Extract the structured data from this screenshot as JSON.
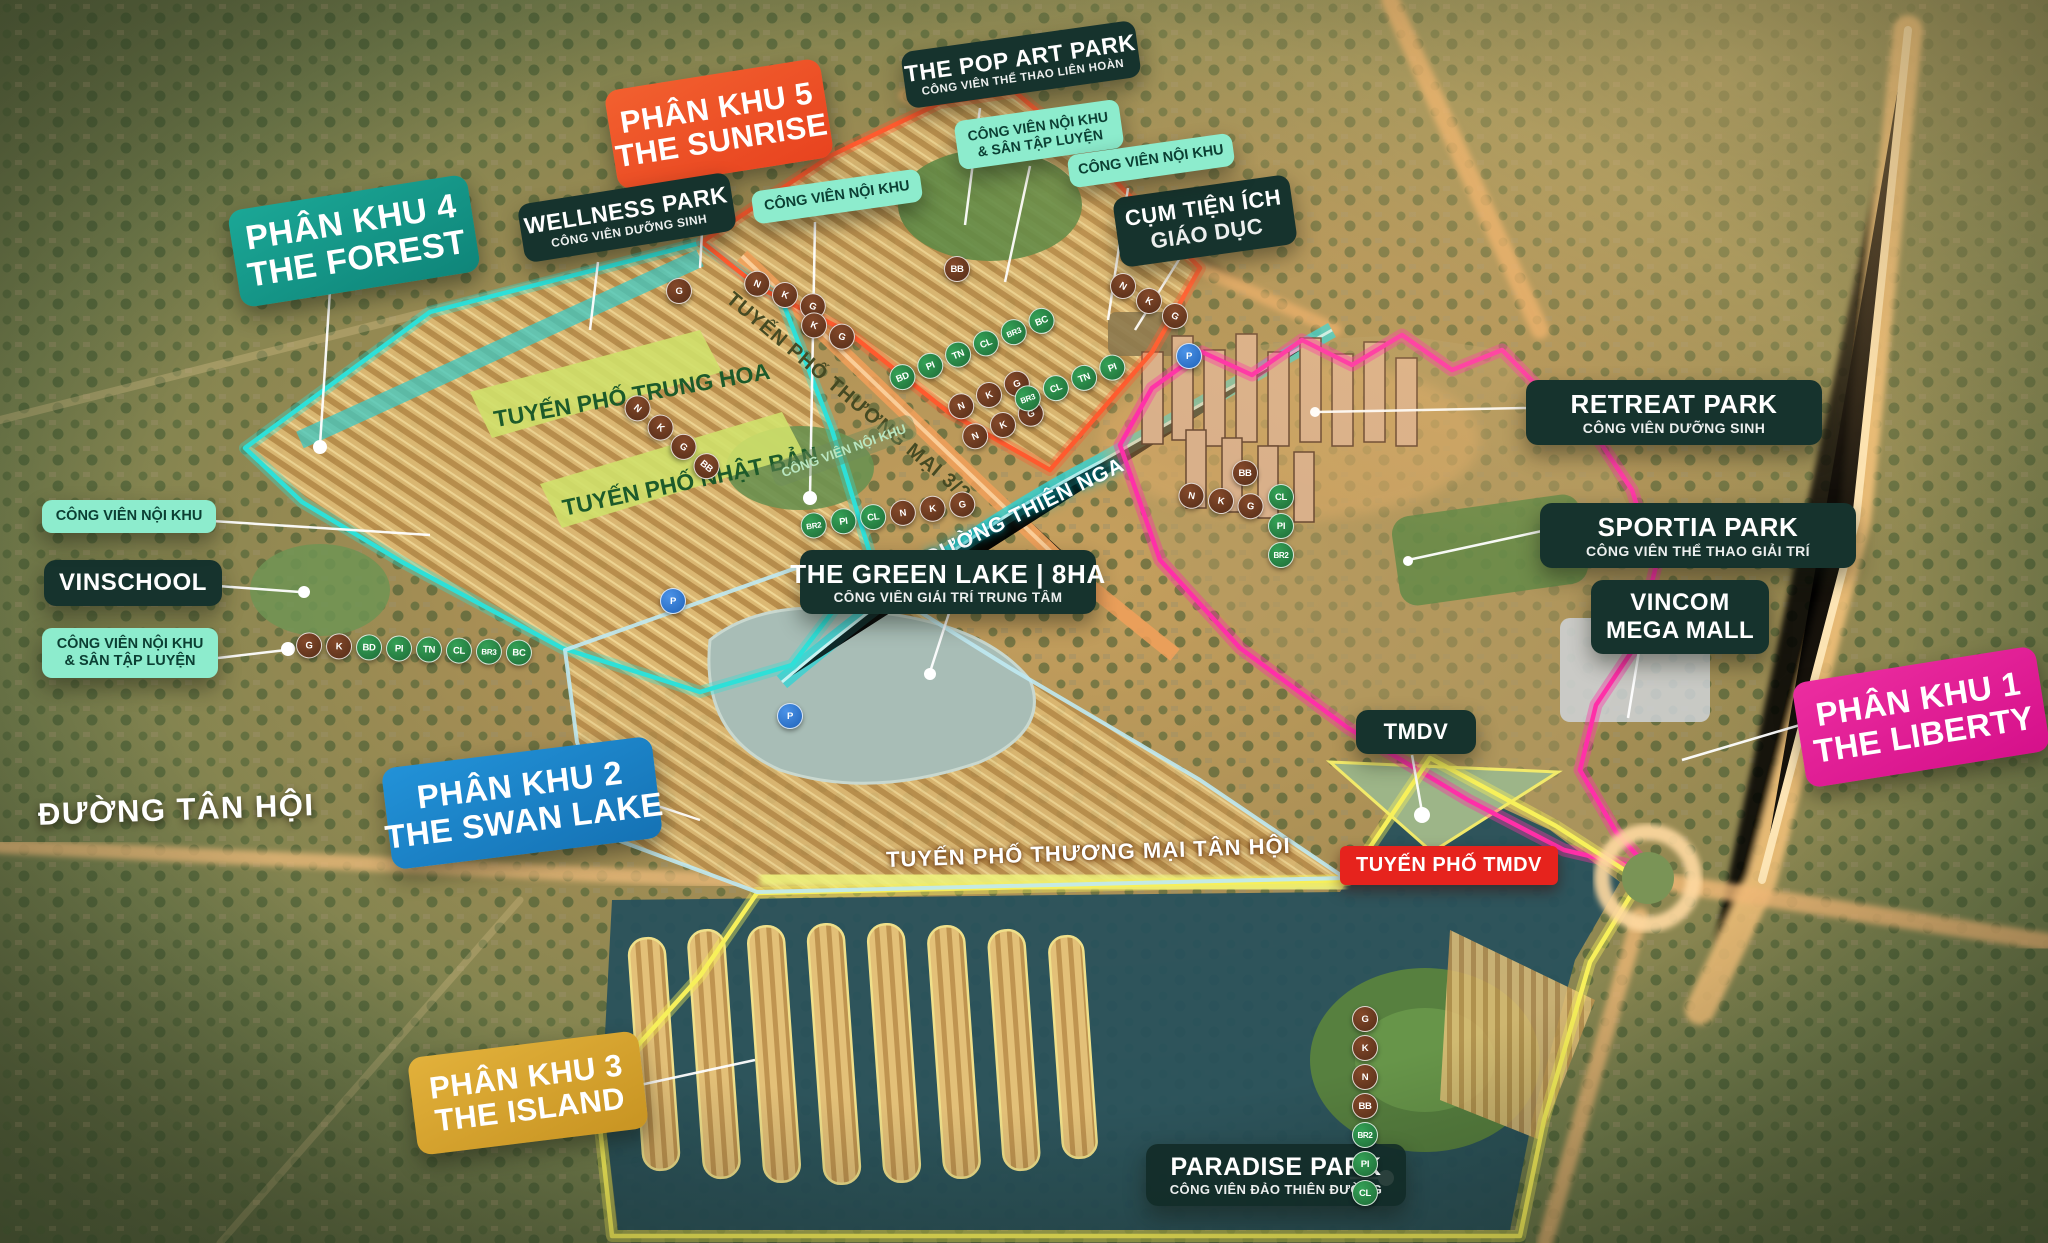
{
  "project": {
    "type": "real-estate masterplan aerial map",
    "colors": {
      "zone1_liberty": "#e0218f",
      "zone2_swan_lake": "#1e85c9",
      "zone3_island": "#d9a62e",
      "zone4_forest": "#14998c",
      "zone5_sunrise": "#f0512f",
      "outline_cyan": "#2ee0d8",
      "outline_orange": "#ff5a2e",
      "outline_magenta": "#ff2fa8",
      "outline_yellow": "#f7f05a",
      "outline_pale_blue": "#bfe9f2",
      "dark_badge": "#16332d",
      "mint_badge": "#8deccd",
      "red_badge": "#e6231d",
      "marker_brown": "#6d3a22",
      "marker_green": "#2e8f4b",
      "marker_blue": "#2e7fd9"
    }
  },
  "zones": {
    "pk1": {
      "line1": "PHÂN KHU 1",
      "line2": "THE LIBERTY"
    },
    "pk2": {
      "line1": "PHÂN KHU 2",
      "line2": "THE SWAN LAKE"
    },
    "pk3": {
      "line1": "PHÂN KHU 3",
      "line2": "THE ISLAND"
    },
    "pk4": {
      "line1": "PHÂN KHU 4",
      "line2": "THE FOREST"
    },
    "pk5": {
      "line1": "PHÂN KHU 5",
      "line2": "THE SUNRISE"
    }
  },
  "parks": {
    "wellness": {
      "title": "WELLNESS PARK",
      "subtitle": "CÔNG VIÊN DƯỠNG SINH"
    },
    "pop_art": {
      "title": "THE POP ART PARK",
      "subtitle": "CÔNG VIÊN THỂ THAO LIÊN HOÀN"
    },
    "retreat": {
      "title": "RETREAT PARK",
      "subtitle": "CÔNG VIÊN DƯỠNG SINH"
    },
    "sportia": {
      "title": "SPORTIA PARK",
      "subtitle": "CÔNG VIÊN THỂ THAO GIẢI TRÍ"
    },
    "green_lake": {
      "title": "THE GREEN LAKE | 8HA",
      "subtitle": "CÔNG VIÊN GIẢI TRÍ TRUNG TÂM"
    },
    "paradise": {
      "title": "PARADISE PARK",
      "subtitle": "CÔNG VIÊN ĐẢO THIÊN ĐƯỜNG"
    }
  },
  "facilities": {
    "vincom": {
      "line1": "VINCOM",
      "line2": "MEGA MALL"
    },
    "education": {
      "line1": "CỤM TIỆN ÍCH",
      "line2": "GIÁO DỤC"
    },
    "tmdv": {
      "label": "TMDV"
    },
    "vinschool": {
      "label": "VINSCHOOL"
    }
  },
  "mint": {
    "noi_khu": "CÔNG VIÊN NỘI KHU",
    "noi_khu_san": "CÔNG VIÊN NỘI KHU & SÂN TẬP LUYỆN"
  },
  "streets": {
    "trung_hoa": "TUYẾN PHỐ TRUNG HOA",
    "nhat_ban": "TUYẾN PHỐ NHẬT BẢN",
    "thuong_mai_32": "TUYẾN PHỐ THƯƠNG MẠI 3/2",
    "thien_nga": "ĐƯỜNG THIÊN NGA",
    "thuong_mai_tan_hoi": "TUYẾN PHỐ THƯƠNG MẠI TÂN HỘI",
    "tmdv_street": "TUYẾN PHỐ TMDV",
    "duong_tan_hoi": "ĐƯỜNG TÂN HỘI",
    "noi_khu_faint": "CÔNG VIÊN NỘI KHU"
  },
  "markers": {
    "g32_a": [
      {
        "t": "N",
        "c": "b"
      },
      {
        "t": "K",
        "c": "b"
      },
      {
        "t": "G",
        "c": "b"
      }
    ],
    "g32_b": [
      {
        "t": "K",
        "c": "b"
      },
      {
        "t": "G",
        "c": "b"
      }
    ],
    "trunghoa": [
      {
        "t": "N",
        "c": "b"
      },
      {
        "t": "K",
        "c": "b"
      },
      {
        "t": "G",
        "c": "b"
      },
      {
        "t": "BB",
        "c": "b"
      }
    ],
    "green_mid": [
      {
        "t": "BD",
        "c": "g"
      },
      {
        "t": "PI",
        "c": "g"
      },
      {
        "t": "TN",
        "c": "g"
      },
      {
        "t": "CL",
        "c": "g"
      },
      {
        "t": "BR3",
        "c": "g"
      },
      {
        "t": "BC",
        "c": "g"
      }
    ],
    "brown_mid1": [
      {
        "t": "N",
        "c": "b"
      },
      {
        "t": "K",
        "c": "b"
      },
      {
        "t": "G",
        "c": "b"
      }
    ],
    "brown_mid2": [
      {
        "t": "N",
        "c": "b"
      },
      {
        "t": "K",
        "c": "b"
      },
      {
        "t": "G",
        "c": "b"
      }
    ],
    "green_right": [
      {
        "t": "BR3",
        "c": "g"
      },
      {
        "t": "CL",
        "c": "g"
      },
      {
        "t": "TN",
        "c": "g"
      },
      {
        "t": "PI",
        "c": "g"
      }
    ],
    "south_mix": [
      {
        "t": "BR2",
        "c": "g"
      },
      {
        "t": "PI",
        "c": "g"
      },
      {
        "t": "CL",
        "c": "g"
      },
      {
        "t": "N",
        "c": "b"
      },
      {
        "t": "K",
        "c": "b"
      },
      {
        "t": "G",
        "c": "b"
      }
    ],
    "left_chain": [
      {
        "t": "G",
        "c": "b"
      },
      {
        "t": "K",
        "c": "b"
      },
      {
        "t": "BD",
        "c": "g"
      },
      {
        "t": "PI",
        "c": "g"
      },
      {
        "t": "TN",
        "c": "g"
      },
      {
        "t": "CL",
        "c": "g"
      },
      {
        "t": "BR3",
        "c": "g"
      },
      {
        "t": "BC",
        "c": "g"
      }
    ],
    "north_single": [
      {
        "t": "BB",
        "c": "b"
      }
    ],
    "west_single": [
      {
        "t": "G",
        "c": "b"
      }
    ],
    "north_chain": [
      {
        "t": "N",
        "c": "b"
      },
      {
        "t": "K",
        "c": "b"
      },
      {
        "t": "G",
        "c": "b"
      }
    ],
    "liberty_bb": [
      {
        "t": "BB",
        "c": "b"
      }
    ],
    "liberty_row": [
      {
        "t": "N",
        "c": "b"
      },
      {
        "t": "K",
        "c": "b"
      },
      {
        "t": "G",
        "c": "b"
      }
    ],
    "liberty_col": [
      {
        "t": "CL",
        "c": "g"
      },
      {
        "t": "PI",
        "c": "g"
      },
      {
        "t": "BR2",
        "c": "g"
      }
    ],
    "paradise_col": [
      {
        "t": "G",
        "c": "b"
      },
      {
        "t": "K",
        "c": "b"
      },
      {
        "t": "N",
        "c": "b"
      },
      {
        "t": "BB",
        "c": "b"
      },
      {
        "t": "BR2",
        "c": "g"
      },
      {
        "t": "PI",
        "c": "g"
      },
      {
        "t": "CL",
        "c": "g"
      }
    ],
    "parking1": [
      {
        "t": "P",
        "c": "p"
      }
    ],
    "parking2": [
      {
        "t": "P",
        "c": "p"
      }
    ],
    "parking3": [
      {
        "t": "P",
        "c": "p"
      }
    ]
  }
}
